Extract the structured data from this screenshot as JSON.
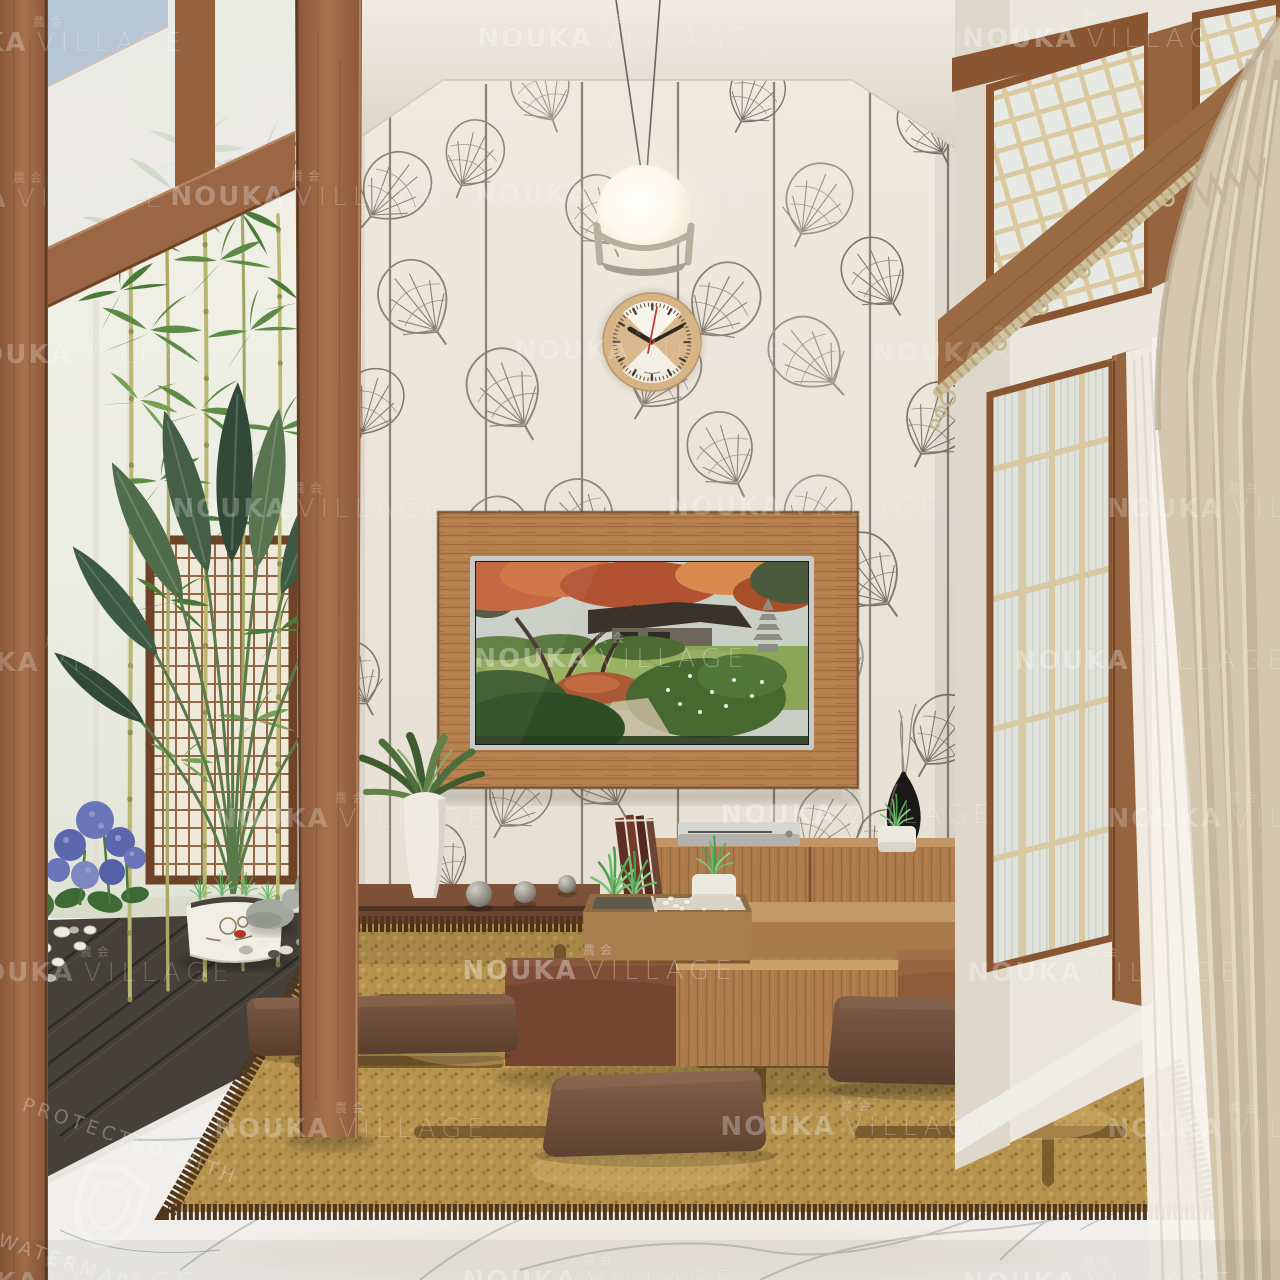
{
  "watermark": {
    "cjk": "農会",
    "brand_bold": "NOUKA",
    "brand_light": "VILLAGE",
    "color": "#ffffff"
  },
  "protection": {
    "line1": "PROTECTED WITH",
    "line2": "WATERMARKLY"
  },
  "clock": {
    "time_shown": "10:10"
  },
  "palette": {
    "wood_frame": "#9a6644",
    "wallpaper": "#ece6da",
    "leaf_motif": "#8d8478",
    "ceiling": "#e9e3d8",
    "tv_panel_wood": "#b5804e",
    "console_wood": "#ad7a4b",
    "plinth": "#6b452f",
    "rug_field": "#b6934f",
    "rug_border": "#4f361c",
    "cushion_leather": "#6b4936",
    "marble_floor": "#f1efec",
    "curtain_beige": "#d5c7ae",
    "sheer_curtain": "#f6f3ec",
    "deck_wood": "#46403a",
    "lattice_bars": "#dbc9a0",
    "bamboo_green": "#5d8a45",
    "plant_green": "#44604a",
    "hydrangea_blue": "#5b66ad",
    "clock_rim": "#d7b486",
    "lamp_glow": "#fffdf4",
    "sky": "#b2c2d4",
    "tv_autumn": "#c2603a",
    "tv_lawn": "#88a455",
    "black_vase": "#1b1917"
  }
}
